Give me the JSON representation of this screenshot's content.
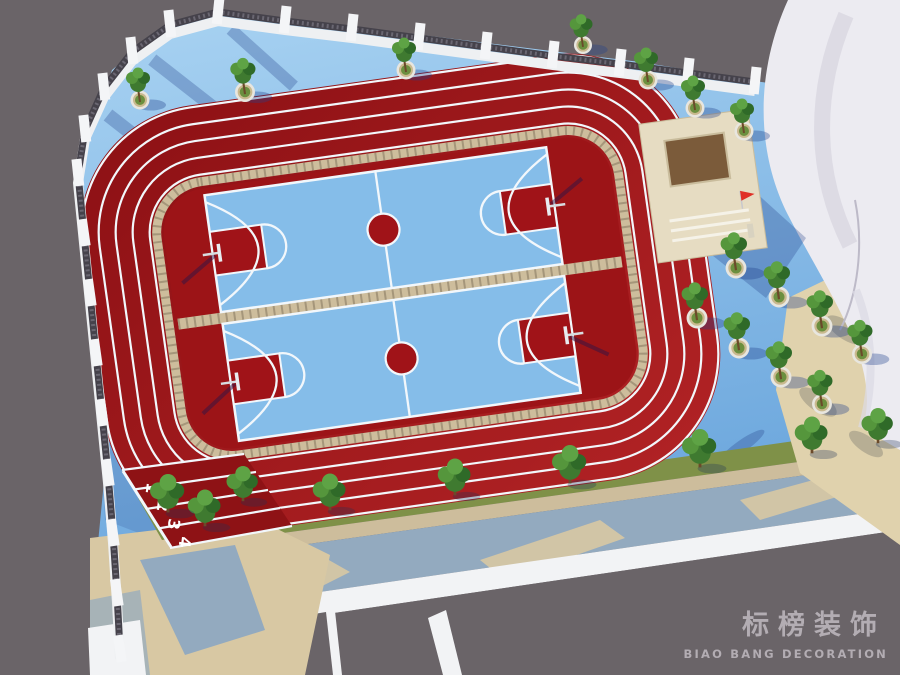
{
  "watermark": {
    "title": "标榜装饰",
    "subtitle": "BIAO BANG DECORATION"
  },
  "track": {
    "lane_numbers": [
      "1",
      "2",
      "3",
      "4"
    ]
  },
  "colors": {
    "outside_gray": "#6A6468",
    "ground_blue": "#7FB9E7",
    "track_red_dark": "#8C1014",
    "track_red_light": "#B22325",
    "infield_red": "#9C1417",
    "chute_red": "#8E1215",
    "court_blue": "#85BDE9",
    "marking_red": "#A01318",
    "grass_green": "#7F9148",
    "brick_tan": "#CDBD9C",
    "paving_beige": "#D8C8A3",
    "paving_bluegray": "#93AABF",
    "parapet_white": "#F2F3F5",
    "fence_dark": "#45424B",
    "pillar_white": "#F4F5F7",
    "structure_white": "#ECEBF1",
    "stage_beige": "#E6DCC2",
    "stage_brown": "#7B5B3A",
    "flag_red": "#E03026",
    "watermark_gray": "#B3ADB3"
  }
}
